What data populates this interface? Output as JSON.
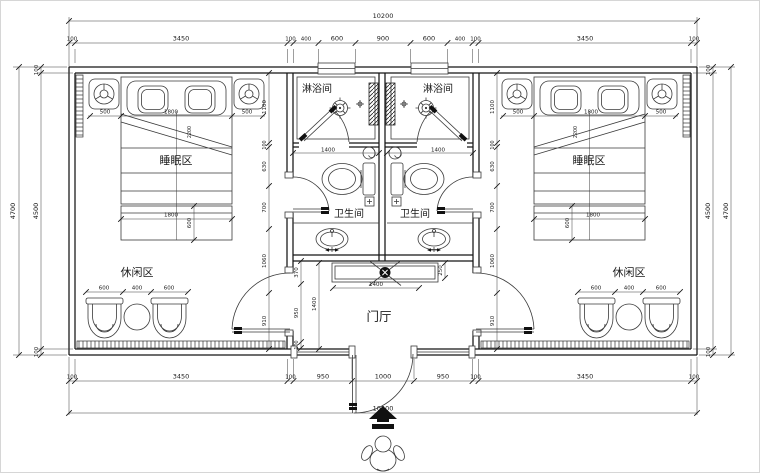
{
  "plan": {
    "total_width": "10200",
    "top_chain": [
      "100",
      "3450",
      "100",
      "400",
      "600",
      "900",
      "600",
      "400",
      "100",
      "3450",
      "100"
    ],
    "bottom_chain": [
      "100",
      "3450",
      "100",
      "950",
      "1000",
      "950",
      "100",
      "3450",
      "100"
    ],
    "side_outer": "4700",
    "side_inner": "4500",
    "wall_thickness": "100",
    "room_side_chain": [
      "1100",
      "100",
      "630",
      "700",
      "1060",
      "910"
    ],
    "bed_chain": [
      "500",
      "1800",
      "500"
    ],
    "bed_diagonal": "2200",
    "bench": {
      "width": "1800",
      "depth": "600"
    },
    "lounge_chain": [
      "600",
      "400",
      "600"
    ],
    "wc_width": "1400",
    "foyer_side_chain": [
      "370",
      "950",
      "100"
    ],
    "foyer_cabinet_width": "1400",
    "foyer_depth": "1400",
    "cabinet_depth": "250",
    "rooms": {
      "shower": "淋浴间",
      "sleeping": "睡眠区",
      "toilet": "卫生间",
      "lounge": "休闲区",
      "foyer": "门厅"
    }
  }
}
